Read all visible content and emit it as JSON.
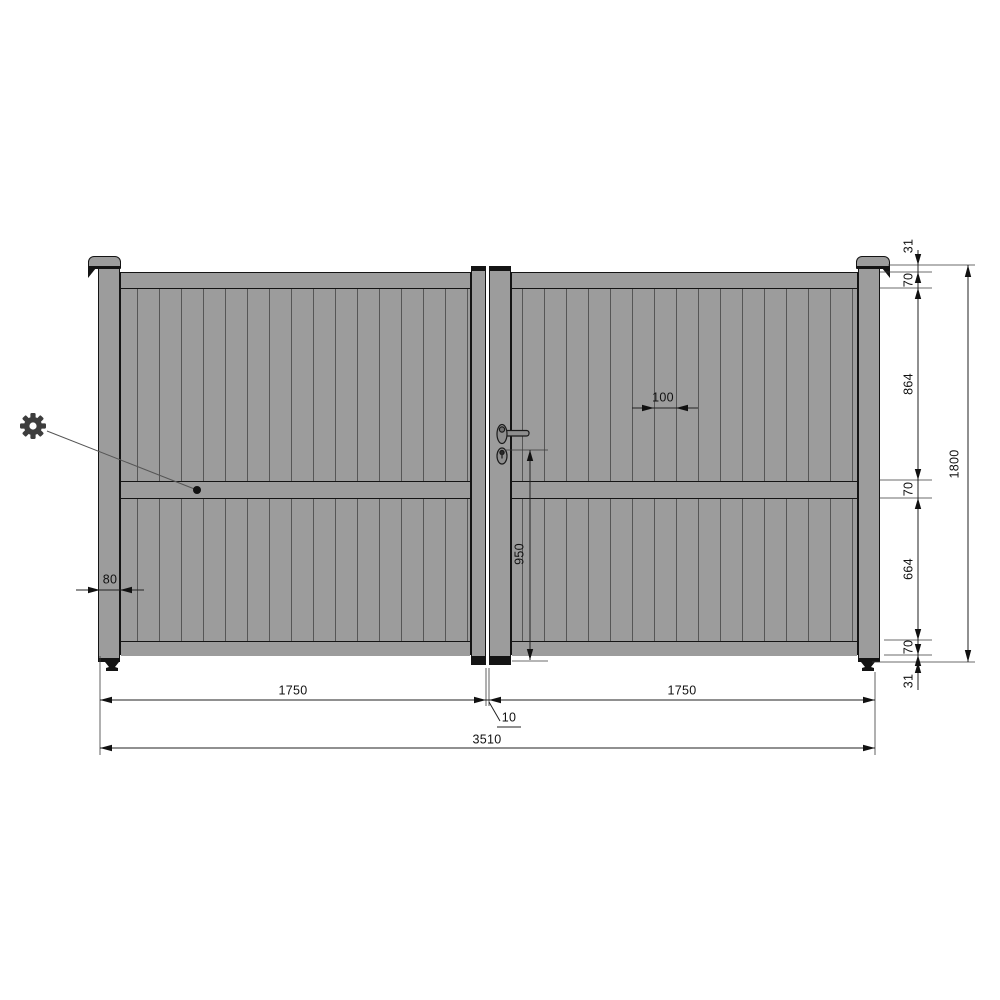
{
  "drawing": {
    "kind": "double-swing-gate front elevation",
    "dimensions": {
      "vertical_chain": [
        "31",
        "70",
        "864",
        "70",
        "664",
        "70",
        "31"
      ],
      "overall_height": "1800",
      "handle_height": "950",
      "slat_pitch": "100",
      "post_width": "80",
      "left_leaf_width": "1750",
      "right_leaf_width": "1750",
      "leaf_gap": "10",
      "overall_width": "3510"
    },
    "icons": {
      "gear": "gear-icon"
    },
    "colors": {
      "panel": "#9c9c9c",
      "outline": "#141414",
      "slat_line": "#565656",
      "dimension_line": "#222222",
      "text": "#111111",
      "background": "#ffffff"
    }
  }
}
